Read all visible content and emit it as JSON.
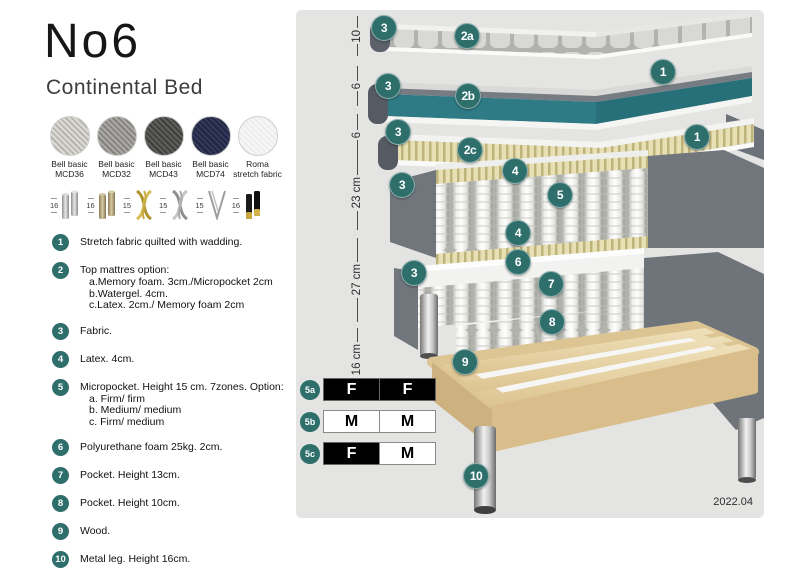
{
  "header": {
    "title": "No6",
    "subtitle": "Continental Bed"
  },
  "swatches": [
    {
      "line1": "Bell basic",
      "line2": "MCD36",
      "base": "#dbd9d4",
      "weave": "#b2b0ab"
    },
    {
      "line1": "Bell basic",
      "line2": "MCD32",
      "base": "#a9a7a3",
      "weave": "#807e7a"
    },
    {
      "line1": "Bell basic",
      "line2": "MCD43",
      "base": "#5c5c5a",
      "weave": "#3b3b39"
    },
    {
      "line1": "Bell basic",
      "line2": "MCD74",
      "base": "#333858",
      "weave": "#1e233f"
    },
    {
      "line1": "Roma",
      "line2": "stretch fabric",
      "base": "#f6f6f6",
      "weave": "#ececec"
    }
  ],
  "leg_options": [
    {
      "height": "16",
      "type": "cylinder-silver"
    },
    {
      "height": "16",
      "type": "cylinder-wood"
    },
    {
      "height": "15",
      "type": "twist-gold"
    },
    {
      "height": "15",
      "type": "twist-silver"
    },
    {
      "height": "15",
      "type": "hairpin"
    },
    {
      "height": "16",
      "type": "cylinder-black-gold"
    }
  ],
  "legend": [
    {
      "num": "1",
      "text": "Stretch fabric quilted with wadding.",
      "sub": []
    },
    {
      "num": "2",
      "text": "Top mattres option:",
      "sub": [
        "a.Memory foam. 3cm./Micropocket 2cm",
        "b.Watergel. 4cm.",
        "c.Latex. 2cm./ Memory foam 2cm"
      ]
    },
    {
      "num": "3",
      "text": "Fabric.",
      "sub": []
    },
    {
      "num": "4",
      "text": "Latex. 4cm.",
      "sub": []
    },
    {
      "num": "5",
      "text": "Micropocket. Height 15 cm. 7zones. Option:",
      "sub": [
        "a. Firm/ firm",
        "b. Medium/ medium",
        "c. Firm/ medium"
      ]
    },
    {
      "num": "6",
      "text": "Polyurethane foam 25kg. 2cm.",
      "sub": []
    },
    {
      "num": "7",
      "text": "Pocket. Height 13cm.",
      "sub": []
    },
    {
      "num": "8",
      "text": "Pocket. Height 10cm.",
      "sub": []
    },
    {
      "num": "9",
      "text": "Wood.",
      "sub": []
    },
    {
      "num": "10",
      "text": "Metal leg. Height 16cm.",
      "sub": []
    }
  ],
  "diagram": {
    "dimensions": [
      {
        "label": "10",
        "top": 6,
        "height": 40
      },
      {
        "label": "6",
        "top": 56,
        "height": 40
      },
      {
        "label": "6",
        "top": 104,
        "height": 42
      },
      {
        "label": "23 cm",
        "top": 146,
        "height": 74
      },
      {
        "label": "27 cm",
        "top": 228,
        "height": 84
      },
      {
        "label": "16 cm",
        "top": 318,
        "height": 64
      }
    ],
    "callouts": [
      {
        "label": "3",
        "x": 88,
        "y": 18
      },
      {
        "label": "2a",
        "x": 171,
        "y": 26
      },
      {
        "label": "1",
        "x": 367,
        "y": 62
      },
      {
        "label": "3",
        "x": 92,
        "y": 76
      },
      {
        "label": "2b",
        "x": 172,
        "y": 86
      },
      {
        "label": "1",
        "x": 401,
        "y": 127
      },
      {
        "label": "3",
        "x": 102,
        "y": 122
      },
      {
        "label": "2c",
        "x": 174,
        "y": 140
      },
      {
        "label": "3",
        "x": 106,
        "y": 175
      },
      {
        "label": "4",
        "x": 219,
        "y": 161
      },
      {
        "label": "5",
        "x": 264,
        "y": 185
      },
      {
        "label": "4",
        "x": 222,
        "y": 223
      },
      {
        "label": "6",
        "x": 222,
        "y": 252
      },
      {
        "label": "7",
        "x": 255,
        "y": 274
      },
      {
        "label": "3",
        "x": 118,
        "y": 263
      },
      {
        "label": "8",
        "x": 256,
        "y": 312
      },
      {
        "label": "9",
        "x": 169,
        "y": 352
      },
      {
        "label": "10",
        "x": 180,
        "y": 466
      }
    ],
    "firmness": [
      {
        "label": "5a",
        "top": 368,
        "cells": [
          {
            "text": "F",
            "style": "dark"
          },
          {
            "text": "F",
            "style": "dark"
          }
        ]
      },
      {
        "label": "5b",
        "top": 400,
        "cells": [
          {
            "text": "M",
            "style": "light"
          },
          {
            "text": "M",
            "style": "light"
          }
        ]
      },
      {
        "label": "5c",
        "top": 432,
        "cells": [
          {
            "text": "F",
            "style": "dark"
          },
          {
            "text": "M",
            "style": "light"
          }
        ]
      }
    ],
    "version": "2022.04"
  },
  "colors": {
    "teal": "#2e6f6c",
    "watergel": "#2e7b85",
    "panel": "#e4e4e3"
  }
}
